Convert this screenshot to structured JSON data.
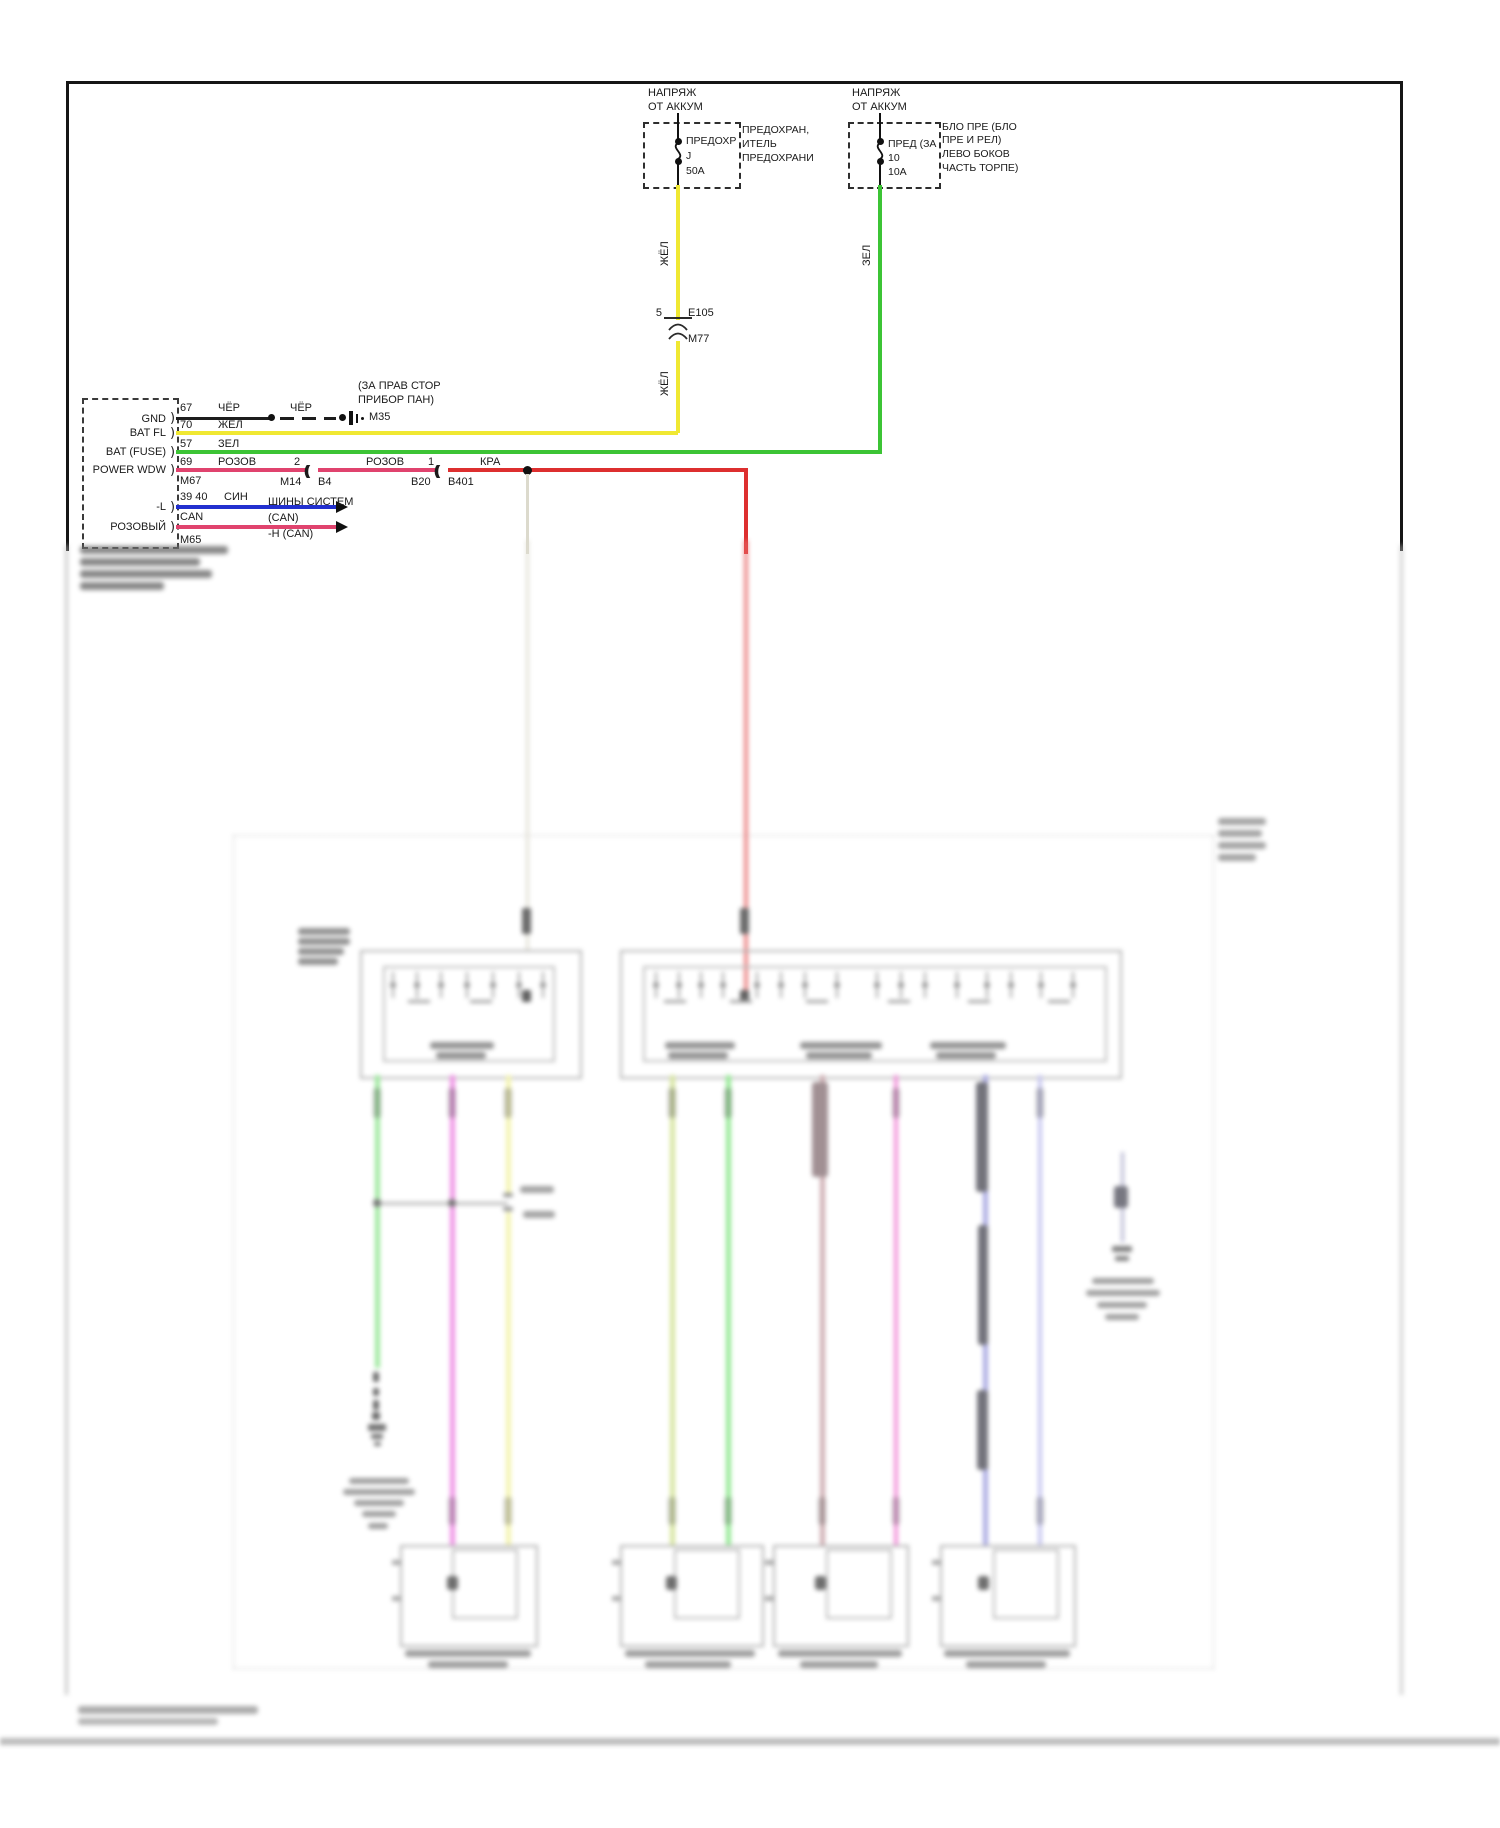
{
  "colors": {
    "wire_yellow": "#f0e832",
    "wire_green": "#3cc435",
    "wire_pink": "#e0436e",
    "wire_red": "#dd2f2f",
    "wire_blue": "#2230cf",
    "wire_black": "#1d1d1d",
    "wire_gray": "#dcdacd",
    "blur_green": "#8ae48a",
    "blur_magenta": "#ec7ce0",
    "blur_yellow": "#f2f2a0",
    "blur_olive": "#cfe08e",
    "blur_green2": "#7fe67f",
    "blur_mauve": "#c49da2",
    "blur_magenta2": "#ef7cd2",
    "blur_periwinkle": "#9a9ade",
    "blur_lightperiwinkle": "#babaec",
    "blur_red": "#e87070"
  },
  "fuses": [
    {
      "feed_line1": "НАПРЯЖ",
      "feed_line2": "ОТ АККУМ",
      "inline_label": "ПРЕДОХР",
      "id": "J",
      "rating": "50A",
      "side_label_lines": [
        "ПРЕДОХРАН,",
        "ИТЕЛЬ",
        "ПРЕДОХРАНИ"
      ]
    },
    {
      "feed_line1": "НАПРЯЖ",
      "feed_line2": "ОТ АККУМ",
      "inline_label": "ПРЕД (ЗА",
      "id": "10",
      "rating": "10A",
      "side_label_lines": [
        "БЛО ПРЕ (БЛО",
        "ПРЕ И РЕЛ)",
        "ЛЕВО БОКОВ",
        "ЧАСТЬ ТОРПЕ)"
      ]
    }
  ],
  "feeds": {
    "yellow_label_upper": "ЖЁЛ",
    "yellow_label_lower": "ЖЁЛ",
    "green_label": "ЗЕЛ"
  },
  "inline_connector": {
    "pin": "5",
    "name": "E105",
    "lower_name": "M77"
  },
  "ground": {
    "location_line1": "(ЗА ПРАВ СТОР",
    "location_line2": "ПРИБОР ПАН)",
    "name": "M35",
    "wire_label_a": "ЧЁР",
    "wire_label_b": "ЧЁР"
  },
  "module": {
    "rows": [
      {
        "label": "GND",
        "pin": "67",
        "wire": "ЧЁР"
      },
      {
        "label": "BAT FL",
        "pin": "70",
        "wire": "ЖЁЛ"
      },
      {
        "label": "BAT (FUSE)",
        "pin": "57",
        "wire": "ЗЕЛ"
      },
      {
        "label": "POWER WDW",
        "pin": "69",
        "wire": "РОЗОВ"
      }
    ],
    "connector_a": "M67",
    "connector_b": "M65",
    "can_row_l": {
      "label": "-L",
      "pins": "39 40",
      "wire": "СИН",
      "dest_line1": "ШИНЫ СИСТЕМ",
      "dest_line2": "(CAN)"
    },
    "can_row_h": {
      "label": "РОЗОВЫЙ",
      "pins": "CAN",
      "dest": "-H (CAN)"
    }
  },
  "power_window_path": {
    "conn1_pin": "2",
    "conn1_a": "M14",
    "conn1_b": "B4",
    "seg2_color": "РОЗОВ",
    "conn2_pin": "1",
    "conn2_a": "B20",
    "conn2_b": "B401",
    "seg3_color": "КРА"
  }
}
